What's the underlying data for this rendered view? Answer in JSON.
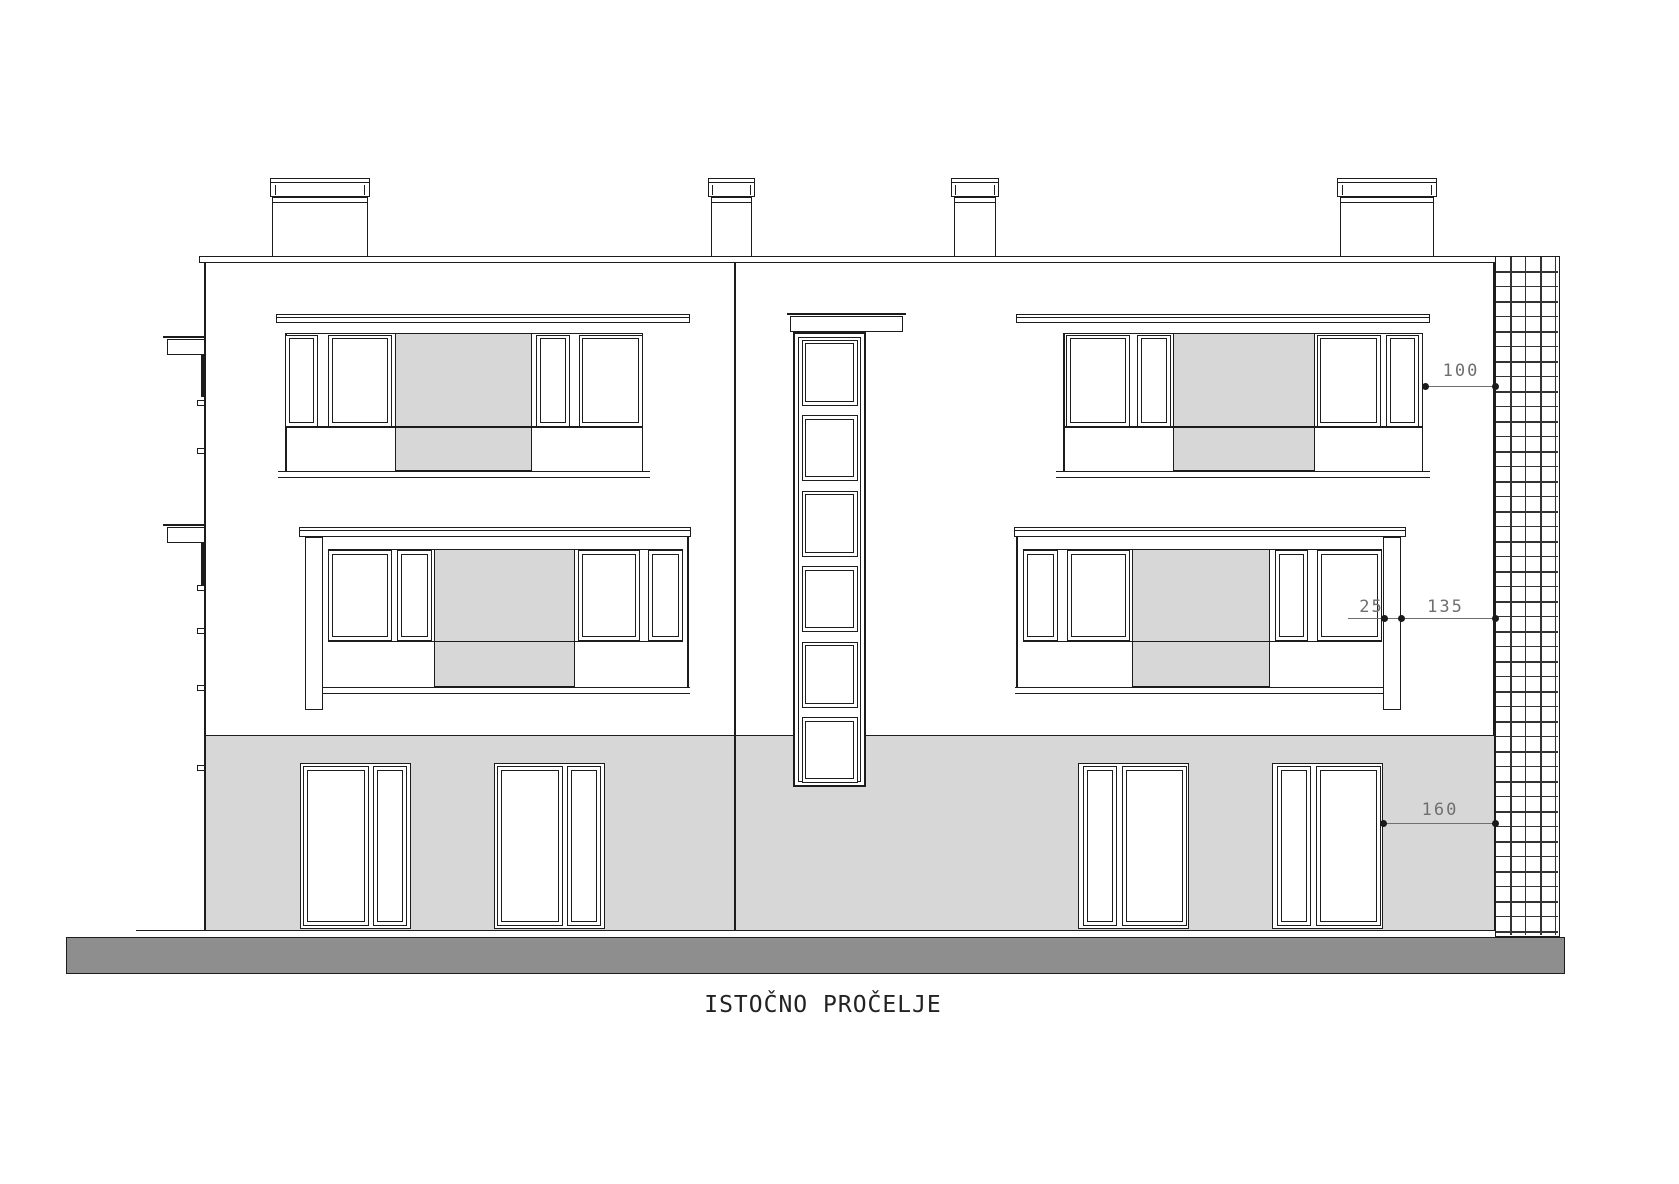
{
  "drawing": {
    "title": "ISTOČNO PROČELJE"
  },
  "dims": {
    "v100": "100",
    "v25": "25",
    "v135": "135",
    "v160": "160"
  },
  "colors": {
    "line": "#1c1c1c",
    "panel_gray": "#d7d7d7",
    "ground_gray": "#d7d7d7",
    "base_gray": "#8e8e8e",
    "dim_line": "#6f6f6f",
    "dim_text": "#6f6f6f",
    "hatch_line": "#333333",
    "background": "#ffffff"
  }
}
